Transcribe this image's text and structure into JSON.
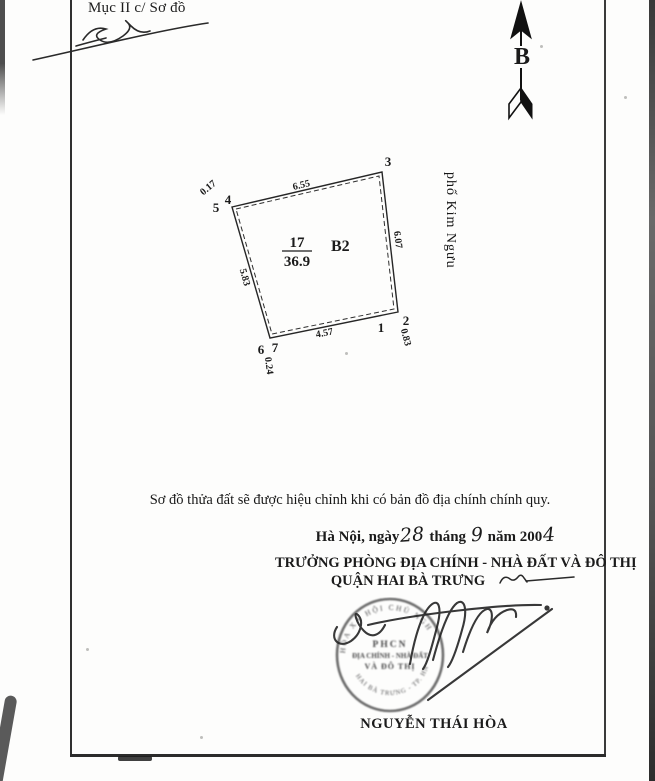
{
  "document": {
    "header_label": "Mục II c/ Sơ đồ",
    "compass_label": "B",
    "parcel": {
      "plot_number": "17",
      "area": "36.9",
      "block_label": "B2",
      "street_label": "phố Kim Ngưu",
      "vertex_labels": {
        "v1": "1",
        "v2": "2",
        "v3": "3",
        "v4": "4",
        "v5": "5",
        "v6": "6",
        "v7": "7"
      },
      "dimensions": {
        "top": "6.55",
        "right": "6.07",
        "bottom": "4.57",
        "left": "5.83",
        "offset_top_left": "0.17",
        "offset_bottom_left": "0.24",
        "offset_bottom_right": "0.83"
      }
    },
    "note": "Sơ đồ thửa đất sẽ được hiệu chỉnh khi có bản đồ địa chính chính quy.",
    "dateline": {
      "prefix": "Hà Nội, ngày",
      "day": "28",
      "month_label": "tháng",
      "month": "9",
      "year_label": "năm 200",
      "year_digit": "4"
    },
    "authority": {
      "title_line1": "TRƯỞNG PHÒNG ĐỊA CHÍNH - NHÀ ĐẤT VÀ ĐÔ THỊ",
      "title_line2": "QUẬN HAI BÀ TRƯNG",
      "signer_name": "NGUYỄN THÁI HÒA"
    },
    "stamp": {
      "ring_top": "HÒA XÃ HỘI CHỦ NGH",
      "ring_bottom": "HAI BÀ TRƯNG - TP. HN",
      "center_line1": "PHCN",
      "center_line2": "ĐỊA CHÍNH - NHÀ ĐẤT",
      "center_line3": "VÀ ĐÔ THỊ"
    },
    "ink_color": "#1b1b1b",
    "stamp_color": "#4f4f4f"
  }
}
